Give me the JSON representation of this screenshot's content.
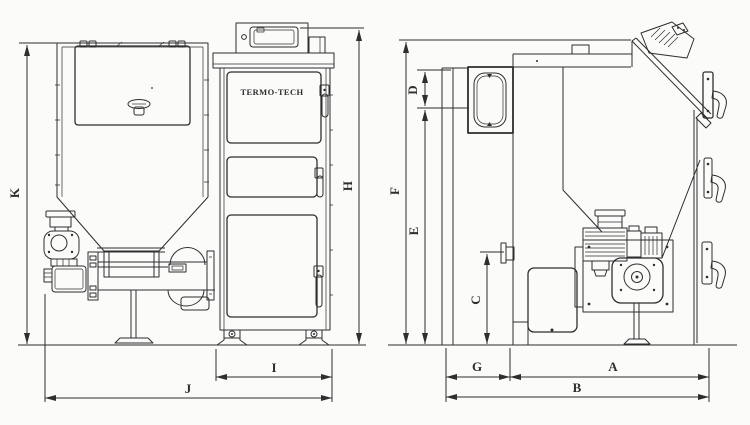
{
  "brand": "TERMO-TECH",
  "dimensions": {
    "A": "A",
    "B": "B",
    "C": "C",
    "D": "D",
    "E": "E",
    "F": "F",
    "G": "G",
    "H": "H",
    "I": "I",
    "J": "J",
    "K": "K"
  },
  "colors": {
    "line": "#2e2e2e",
    "paper": "#fbfbfa"
  }
}
